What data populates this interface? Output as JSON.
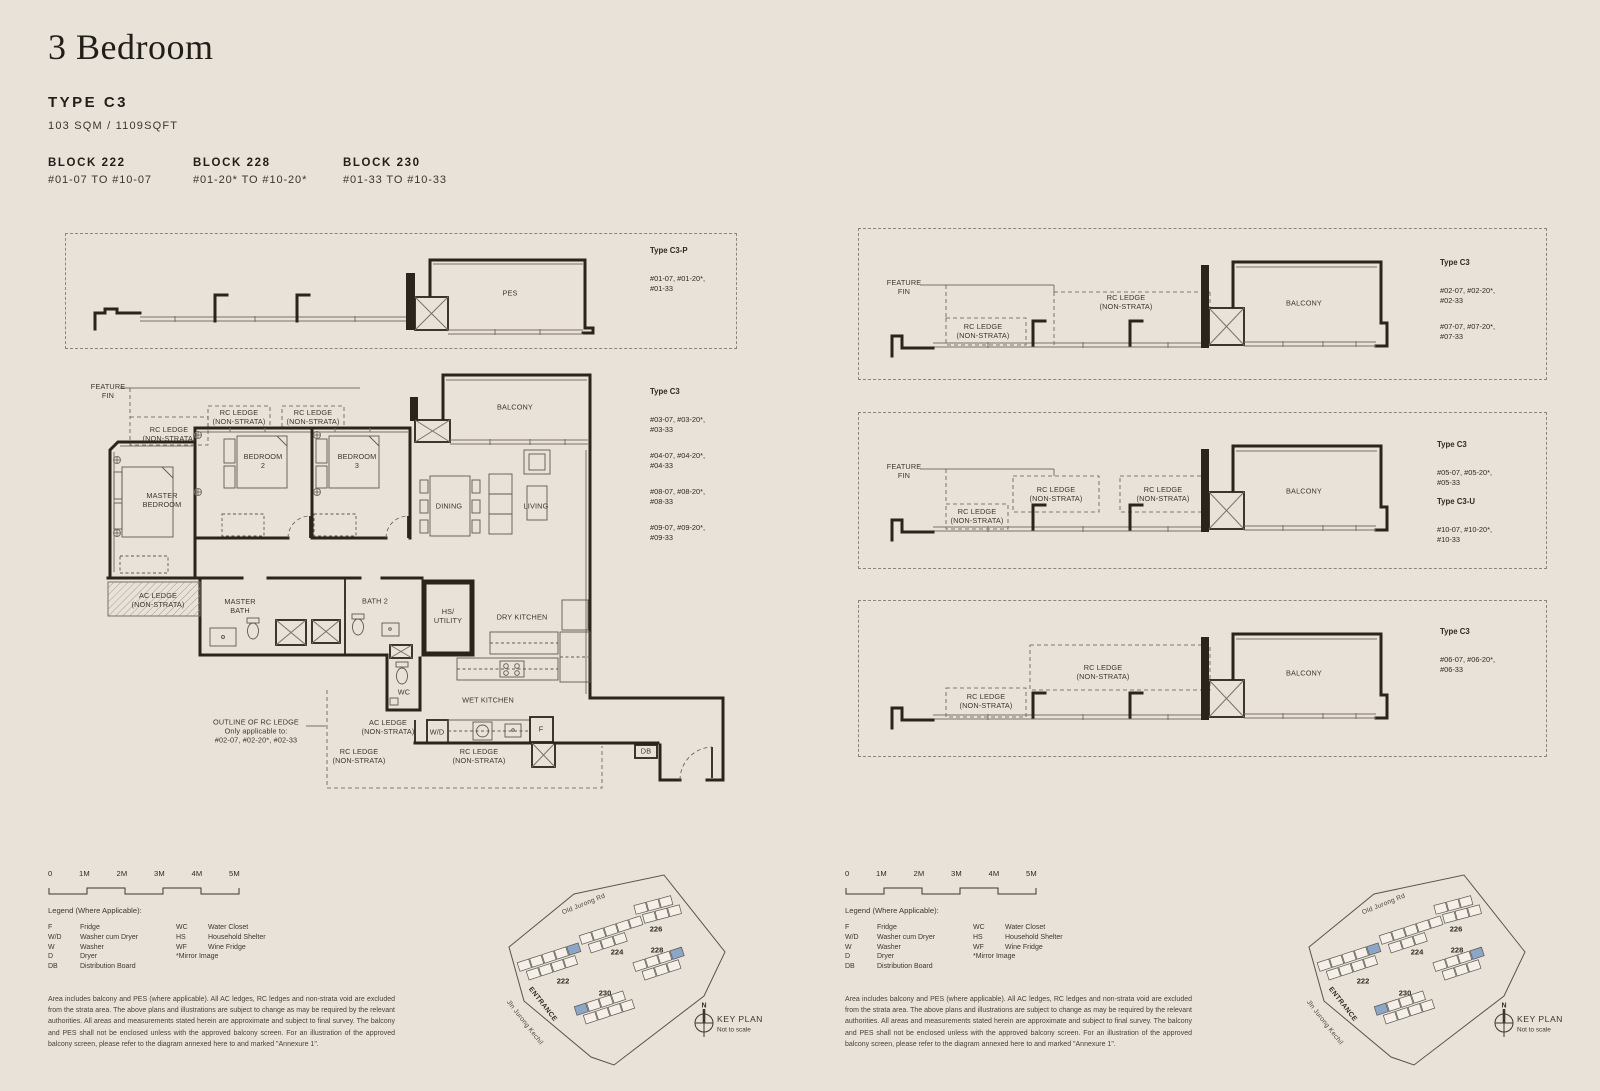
{
  "colors": {
    "bg": "#e9e2d9",
    "ink": "#26211b",
    "wall": "#2a241c",
    "line": "#7a7266",
    "highlight": "#8ba6c7"
  },
  "header": {
    "title": "3 Bedroom",
    "type": "TYPE C3",
    "area": "103 SQM / 1109SQFT",
    "blocks": [
      {
        "name": "BLOCK 222",
        "range": "#01-07 TO #10-07"
      },
      {
        "name": "BLOCK 228",
        "range": "#01-20* TO #10-20*"
      },
      {
        "name": "BLOCK 230",
        "range": "#01-33 TO #10-33"
      }
    ]
  },
  "labels": {
    "feature_fin": "FEATURE\nFIN",
    "rc_ledge": "RC LEDGE\n(NON-STRATA)",
    "ac_ledge": "AC LEDGE\n(NON-STRATA)",
    "pes": "PES",
    "balcony": "BALCONY",
    "master_bedroom": "MASTER\nBEDROOM",
    "bedroom_2": "BEDROOM\n2",
    "bedroom_3": "BEDROOM\n3",
    "dining": "DINING",
    "living": "LIVING",
    "master_bath": "MASTER\nBATH",
    "bath_2": "BATH 2",
    "hs_utility": "HS/\nUTILITY",
    "dry_kitchen": "DRY KITCHEN",
    "wet_kitchen": "WET KITCHEN",
    "wc": "WC",
    "wd": "W/D",
    "f": "F",
    "db": "DB",
    "outline_note": "OUTLINE OF RC LEDGE\nOnly applicable to:\n#02-07, #02-20*, #02-33"
  },
  "plans": {
    "pes": {
      "title": "Type C3-P",
      "units": "#01-07, #01-20*,\n#01-33"
    },
    "main": {
      "title": "Type C3",
      "units": [
        "#03-07, #03-20*,\n#03-33",
        "#04-07, #04-20*,\n#04-33",
        "#08-07, #08-20*,\n#08-33",
        "#09-07, #09-20*,\n#09-33"
      ]
    },
    "section1": {
      "title": "Type C3",
      "units": [
        "#02-07, #02-20*,\n#02-33",
        "#07-07, #07-20*,\n#07-33"
      ]
    },
    "section2": [
      {
        "title": "Type C3",
        "units": "#05-07, #05-20*,\n#05-33"
      },
      {
        "title": "Type C3-U",
        "units": "#10-07, #10-20*,\n#10-33"
      }
    ],
    "section3": {
      "title": "Type C3",
      "units": "#06-07, #06-20*,\n#06-33"
    }
  },
  "footer": {
    "scale_ticks": [
      "0",
      "1M",
      "2M",
      "3M",
      "4M",
      "5M"
    ],
    "legend_title": "Legend (Where Applicable):",
    "legend_col1": [
      {
        "abbr": "F",
        "label": "Fridge"
      },
      {
        "abbr": "W/D",
        "label": "Washer cum Dryer"
      },
      {
        "abbr": "W",
        "label": "Washer"
      },
      {
        "abbr": "D",
        "label": "Dryer"
      },
      {
        "abbr": "DB",
        "label": "Distribution Board"
      }
    ],
    "legend_col2": [
      {
        "abbr": "WC",
        "label": "Water Closet"
      },
      {
        "abbr": "HS",
        "label": "Household Shelter"
      },
      {
        "abbr": "WF",
        "label": "Wine Fridge"
      }
    ],
    "mirror_note": "*Mirror Image",
    "disclaimer": "Area includes balcony and PES (where applicable). All AC ledges, RC ledges and non-strata void are excluded from the strata area. The above plans and illustrations are subject to change as may be required by the relevant authorities. All areas and measurements stated herein are approximate and subject to final survey. The balcony and PES shall not be enclosed unless with the approved balcony screen. For an illustration of the approved balcony screen, please refer to the diagram annexed here to and marked \"Annexure 1\"."
  },
  "keyplan": {
    "road_top": "Old Jurong Rd",
    "road_left": "Jln Jurong Kechil",
    "entrance": "ENTRANCE",
    "blocks": [
      "222",
      "224",
      "226",
      "228",
      "230"
    ],
    "north": "N",
    "title": "KEY PLAN",
    "subtitle": "Not to scale"
  }
}
